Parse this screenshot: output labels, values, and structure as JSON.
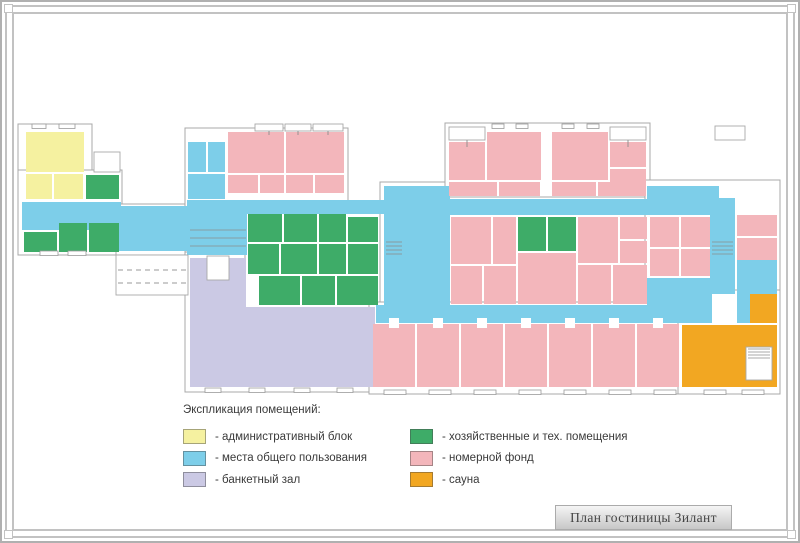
{
  "legend": {
    "title": "Экспликация помещений:",
    "columns": [
      [
        {
          "color": "admin",
          "label": "- административный блок"
        },
        {
          "color": "common",
          "label": "- места общего пользования"
        },
        {
          "color": "banquet",
          "label": "- банкетный зал"
        }
      ],
      [
        {
          "color": "utility",
          "label": "- хозяйственные и тех. помещения"
        },
        {
          "color": "rooms",
          "label": "- номерной фонд"
        },
        {
          "color": "sauna",
          "label": "- сауна"
        }
      ]
    ]
  },
  "title_block": {
    "text": "План гостиницы Зилант"
  },
  "palette": {
    "admin": "#f5f1a0",
    "common": "#7dcee9",
    "banquet": "#cbc9e4",
    "utility": "#3eac68",
    "rooms": "#f3b6bb",
    "sauna": "#f2a722",
    "wall": "#ffffff",
    "outline": "#a8a8a8"
  },
  "plan": {
    "clusters": [
      [
        16,
        122,
        74,
        52
      ],
      [
        16,
        168,
        104,
        85
      ],
      [
        114,
        202,
        74,
        51
      ],
      [
        183,
        126,
        163,
        130
      ],
      [
        183,
        250,
        196,
        140
      ],
      [
        243,
        205,
        139,
        103
      ],
      [
        378,
        180,
        74,
        145
      ],
      [
        443,
        121,
        205,
        76
      ],
      [
        446,
        195,
        267,
        112
      ],
      [
        643,
        178,
        135,
        131
      ],
      [
        367,
        300,
        331,
        92
      ],
      [
        676,
        288,
        102,
        104
      ]
    ],
    "areas": [
      [
        20,
        200,
        99,
        28,
        "common"
      ],
      [
        116,
        204,
        70,
        45,
        "common"
      ],
      [
        185,
        198,
        197,
        14,
        "common"
      ],
      [
        185,
        198,
        60,
        55,
        "common"
      ],
      [
        186,
        140,
        18,
        30,
        "common"
      ],
      [
        206,
        140,
        17,
        30,
        "common"
      ],
      [
        186,
        172,
        37,
        25,
        "common"
      ],
      [
        382,
        184,
        66,
        137,
        "common"
      ],
      [
        448,
        197,
        198,
        16,
        "common"
      ],
      [
        645,
        184,
        72,
        29,
        "common"
      ],
      [
        708,
        196,
        25,
        96,
        "common"
      ],
      [
        735,
        258,
        40,
        63,
        "common"
      ],
      [
        645,
        276,
        65,
        45,
        "common"
      ],
      [
        374,
        303,
        323,
        18,
        "common"
      ],
      [
        24,
        130,
        58,
        40,
        "admin"
      ],
      [
        24,
        172,
        26,
        25,
        "admin"
      ],
      [
        52,
        172,
        29,
        25,
        "admin"
      ],
      [
        84,
        173,
        33,
        24,
        "utility"
      ],
      [
        22,
        230,
        33,
        20,
        "utility"
      ],
      [
        57,
        221,
        28,
        29,
        "utility"
      ],
      [
        87,
        221,
        30,
        29,
        "utility"
      ],
      [
        226,
        130,
        56,
        41,
        "rooms"
      ],
      [
        284,
        130,
        58,
        41,
        "rooms"
      ],
      [
        226,
        173,
        30,
        18,
        "rooms"
      ],
      [
        258,
        173,
        24,
        18,
        "rooms"
      ],
      [
        284,
        173,
        27,
        18,
        "rooms"
      ],
      [
        313,
        173,
        29,
        18,
        "rooms"
      ],
      [
        246,
        212,
        34,
        28,
        "utility"
      ],
      [
        282,
        212,
        33,
        28,
        "utility"
      ],
      [
        317,
        212,
        27,
        28,
        "utility"
      ],
      [
        346,
        215,
        30,
        25,
        "utility"
      ],
      [
        246,
        242,
        31,
        30,
        "utility"
      ],
      [
        279,
        242,
        36,
        30,
        "utility"
      ],
      [
        317,
        242,
        27,
        30,
        "utility"
      ],
      [
        346,
        242,
        30,
        30,
        "utility"
      ],
      [
        257,
        274,
        41,
        29,
        "utility"
      ],
      [
        300,
        274,
        33,
        29,
        "utility"
      ],
      [
        335,
        274,
        41,
        29,
        "utility"
      ],
      [
        188,
        256,
        56,
        129,
        "banquet"
      ],
      [
        242,
        305,
        131,
        80,
        "banquet"
      ],
      [
        447,
        140,
        36,
        38,
        "rooms"
      ],
      [
        485,
        130,
        54,
        48,
        "rooms"
      ],
      [
        550,
        130,
        56,
        48,
        "rooms"
      ],
      [
        608,
        140,
        36,
        25,
        "rooms"
      ],
      [
        608,
        167,
        36,
        26,
        "rooms"
      ],
      [
        447,
        180,
        48,
        14,
        "rooms"
      ],
      [
        497,
        180,
        41,
        14,
        "rooms"
      ],
      [
        550,
        180,
        44,
        14,
        "rooms"
      ],
      [
        596,
        180,
        48,
        14,
        "rooms"
      ],
      [
        449,
        215,
        40,
        47,
        "rooms"
      ],
      [
        491,
        215,
        23,
        47,
        "rooms"
      ],
      [
        516,
        215,
        28,
        34,
        "utility"
      ],
      [
        546,
        215,
        28,
        34,
        "utility"
      ],
      [
        576,
        215,
        40,
        46,
        "rooms"
      ],
      [
        618,
        215,
        27,
        22,
        "rooms"
      ],
      [
        618,
        239,
        27,
        22,
        "rooms"
      ],
      [
        648,
        215,
        29,
        30,
        "rooms"
      ],
      [
        679,
        215,
        29,
        30,
        "rooms"
      ],
      [
        449,
        264,
        31,
        38,
        "rooms"
      ],
      [
        482,
        264,
        32,
        38,
        "rooms"
      ],
      [
        516,
        251,
        58,
        51,
        "rooms"
      ],
      [
        576,
        263,
        33,
        39,
        "rooms"
      ],
      [
        611,
        263,
        34,
        39,
        "rooms"
      ],
      [
        648,
        247,
        29,
        27,
        "rooms"
      ],
      [
        679,
        247,
        29,
        27,
        "rooms"
      ],
      [
        735,
        213,
        40,
        21,
        "rooms"
      ],
      [
        735,
        236,
        40,
        22,
        "rooms"
      ],
      [
        371,
        322,
        42,
        63,
        "rooms"
      ],
      [
        415,
        322,
        42,
        63,
        "rooms"
      ],
      [
        459,
        322,
        42,
        63,
        "rooms"
      ],
      [
        503,
        322,
        42,
        63,
        "rooms"
      ],
      [
        547,
        322,
        42,
        63,
        "rooms"
      ],
      [
        591,
        322,
        42,
        63,
        "rooms"
      ],
      [
        635,
        322,
        42,
        63,
        "rooms"
      ],
      [
        748,
        292,
        27,
        29,
        "sauna"
      ],
      [
        680,
        323,
        95,
        62,
        "sauna"
      ]
    ],
    "outlines": [
      [
        205,
        254,
        22,
        24
      ],
      [
        447,
        125,
        36,
        13
      ],
      [
        608,
        125,
        36,
        13
      ],
      [
        253,
        122,
        28,
        7
      ],
      [
        283,
        122,
        26,
        7
      ],
      [
        311,
        122,
        30,
        7
      ],
      [
        713,
        124,
        30,
        14
      ],
      [
        114,
        253,
        72,
        40
      ],
      [
        744,
        345,
        26,
        33
      ],
      [
        92,
        150,
        26,
        20
      ]
    ],
    "stairs": [
      {
        "x": 384,
        "y": 240,
        "w": 16,
        "n": 4,
        "gap": 4
      },
      {
        "x": 710,
        "y": 240,
        "w": 21,
        "n": 4,
        "gap": 4
      },
      {
        "x": 746,
        "y": 347,
        "w": 22,
        "n": 4,
        "gap": 3
      },
      {
        "x": 188,
        "y": 228,
        "w": 56,
        "n": 3,
        "gap": 8
      }
    ],
    "windows": [
      [
        30,
        122,
        14
      ],
      [
        57,
        122,
        16
      ],
      [
        490,
        122,
        12
      ],
      [
        514,
        122,
        12
      ],
      [
        560,
        122,
        12
      ],
      [
        585,
        122,
        12
      ],
      [
        38,
        249,
        18
      ],
      [
        66,
        249,
        18
      ],
      [
        203,
        386,
        16
      ],
      [
        247,
        386,
        16
      ],
      [
        292,
        386,
        16
      ],
      [
        335,
        386,
        16
      ],
      [
        382,
        388,
        22
      ],
      [
        427,
        388,
        22
      ],
      [
        472,
        388,
        22
      ],
      [
        517,
        388,
        22
      ],
      [
        562,
        388,
        22
      ],
      [
        607,
        388,
        22
      ],
      [
        652,
        388,
        22
      ],
      [
        702,
        388,
        22
      ],
      [
        740,
        388,
        22
      ]
    ],
    "dashes": [
      [
        116,
        268,
        68
      ],
      [
        116,
        281,
        68
      ]
    ],
    "doors": [
      [
        387,
        316,
        10,
        10
      ],
      [
        431,
        316,
        10,
        10
      ],
      [
        475,
        316,
        10,
        10
      ],
      [
        519,
        316,
        10,
        10
      ],
      [
        563,
        316,
        10,
        10
      ],
      [
        607,
        316,
        10,
        10
      ],
      [
        651,
        316,
        10,
        10
      ]
    ],
    "ticks": [
      [
        465,
        138,
        465,
        145
      ],
      [
        626,
        138,
        626,
        145
      ],
      [
        267,
        129,
        267,
        133
      ],
      [
        296,
        129,
        296,
        133
      ],
      [
        326,
        129,
        326,
        133
      ]
    ]
  }
}
